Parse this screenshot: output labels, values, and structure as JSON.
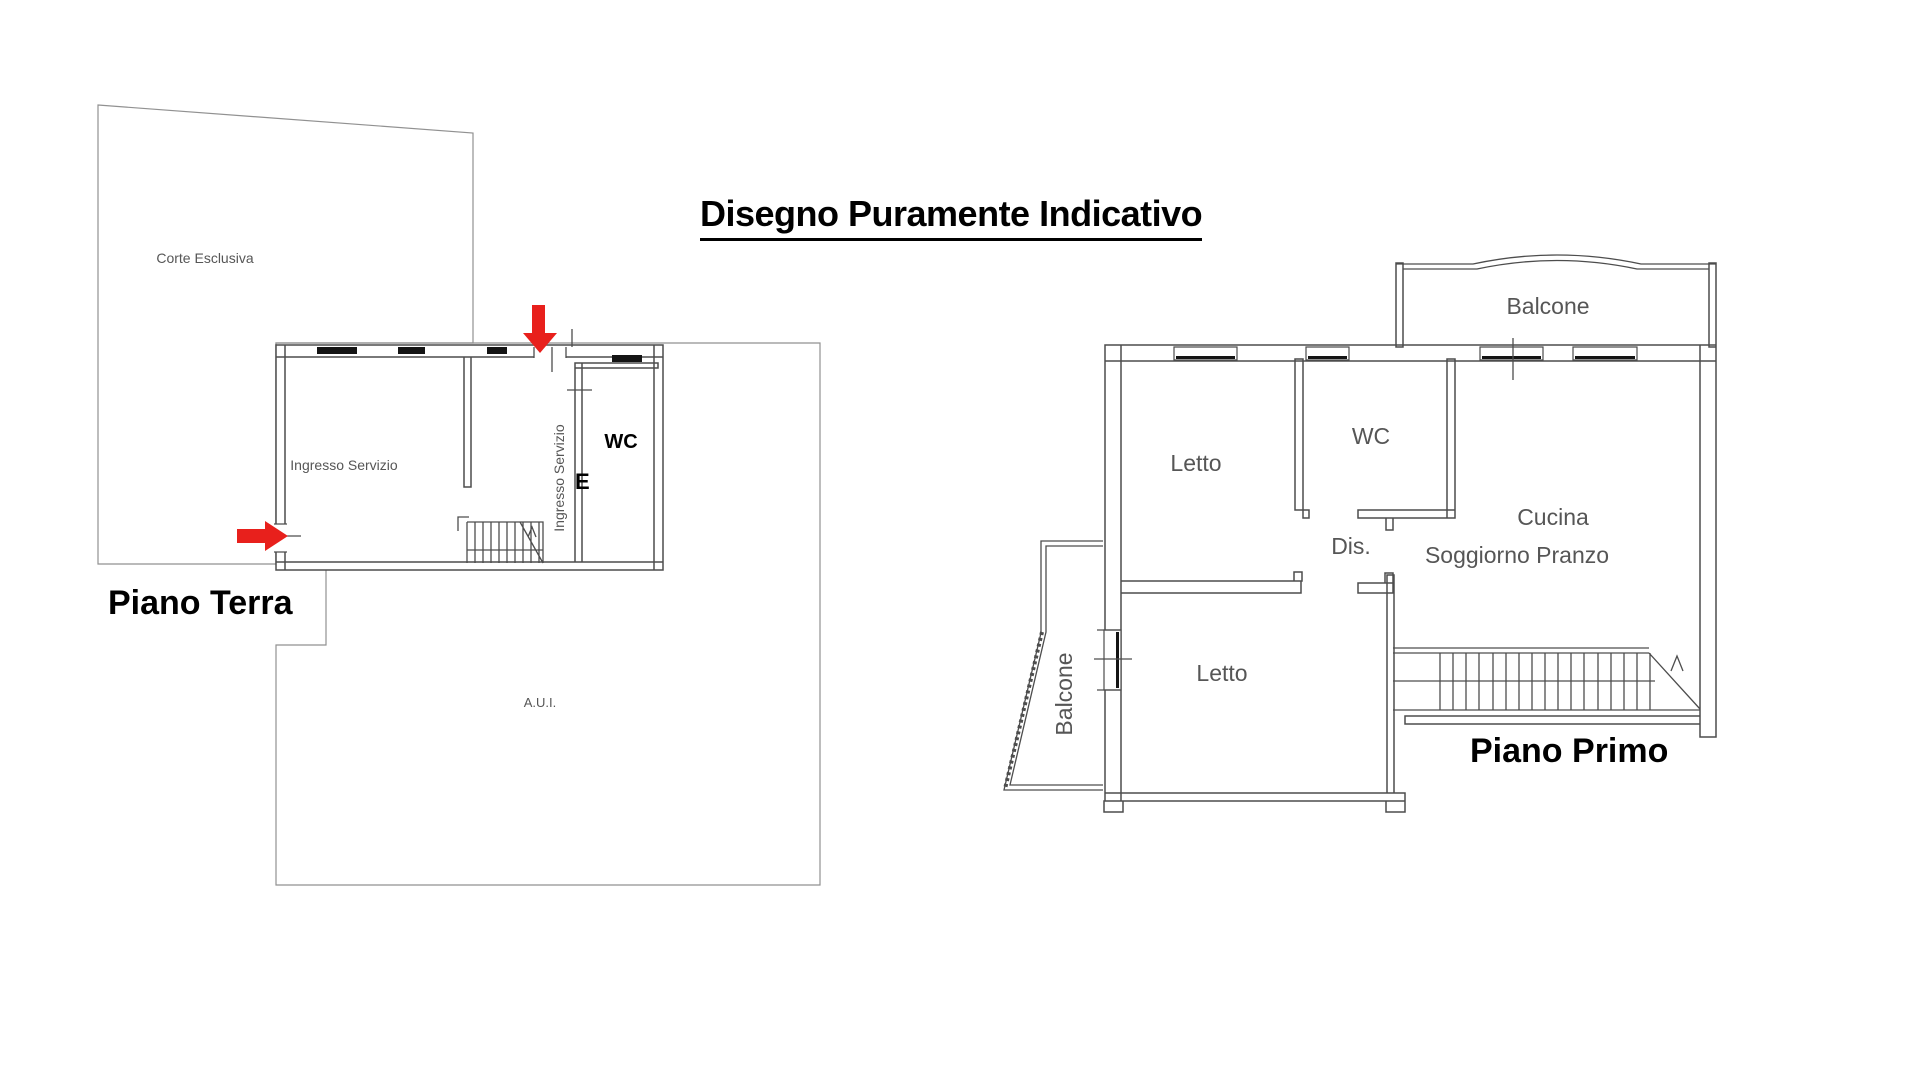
{
  "title": "Disegno Puramente Indicativo",
  "colors": {
    "wall_line": "#4d4d4d",
    "thin_line": "#919191",
    "label_gray": "#565656",
    "arrow_red": "#e8201c",
    "window_fill": "#141414"
  },
  "ground_floor": {
    "heading": "Piano Terra",
    "labels": {
      "corte": "Corte Esclusiva",
      "ingresso_main": "Ingresso Servizio",
      "ingresso_side": "Ingresso Servizio",
      "wc": "WC",
      "e": "E",
      "aui": "A.U.I."
    }
  },
  "first_floor": {
    "heading": "Piano Primo",
    "labels": {
      "balcone_top": "Balcone",
      "letto_upper": "Letto",
      "wc": "WC",
      "dis": "Dis.",
      "cucina": "Cucina",
      "soggiorno": "Soggiorno Pranzo",
      "letto_lower": "Letto",
      "balcone_left": "Balcone"
    }
  }
}
